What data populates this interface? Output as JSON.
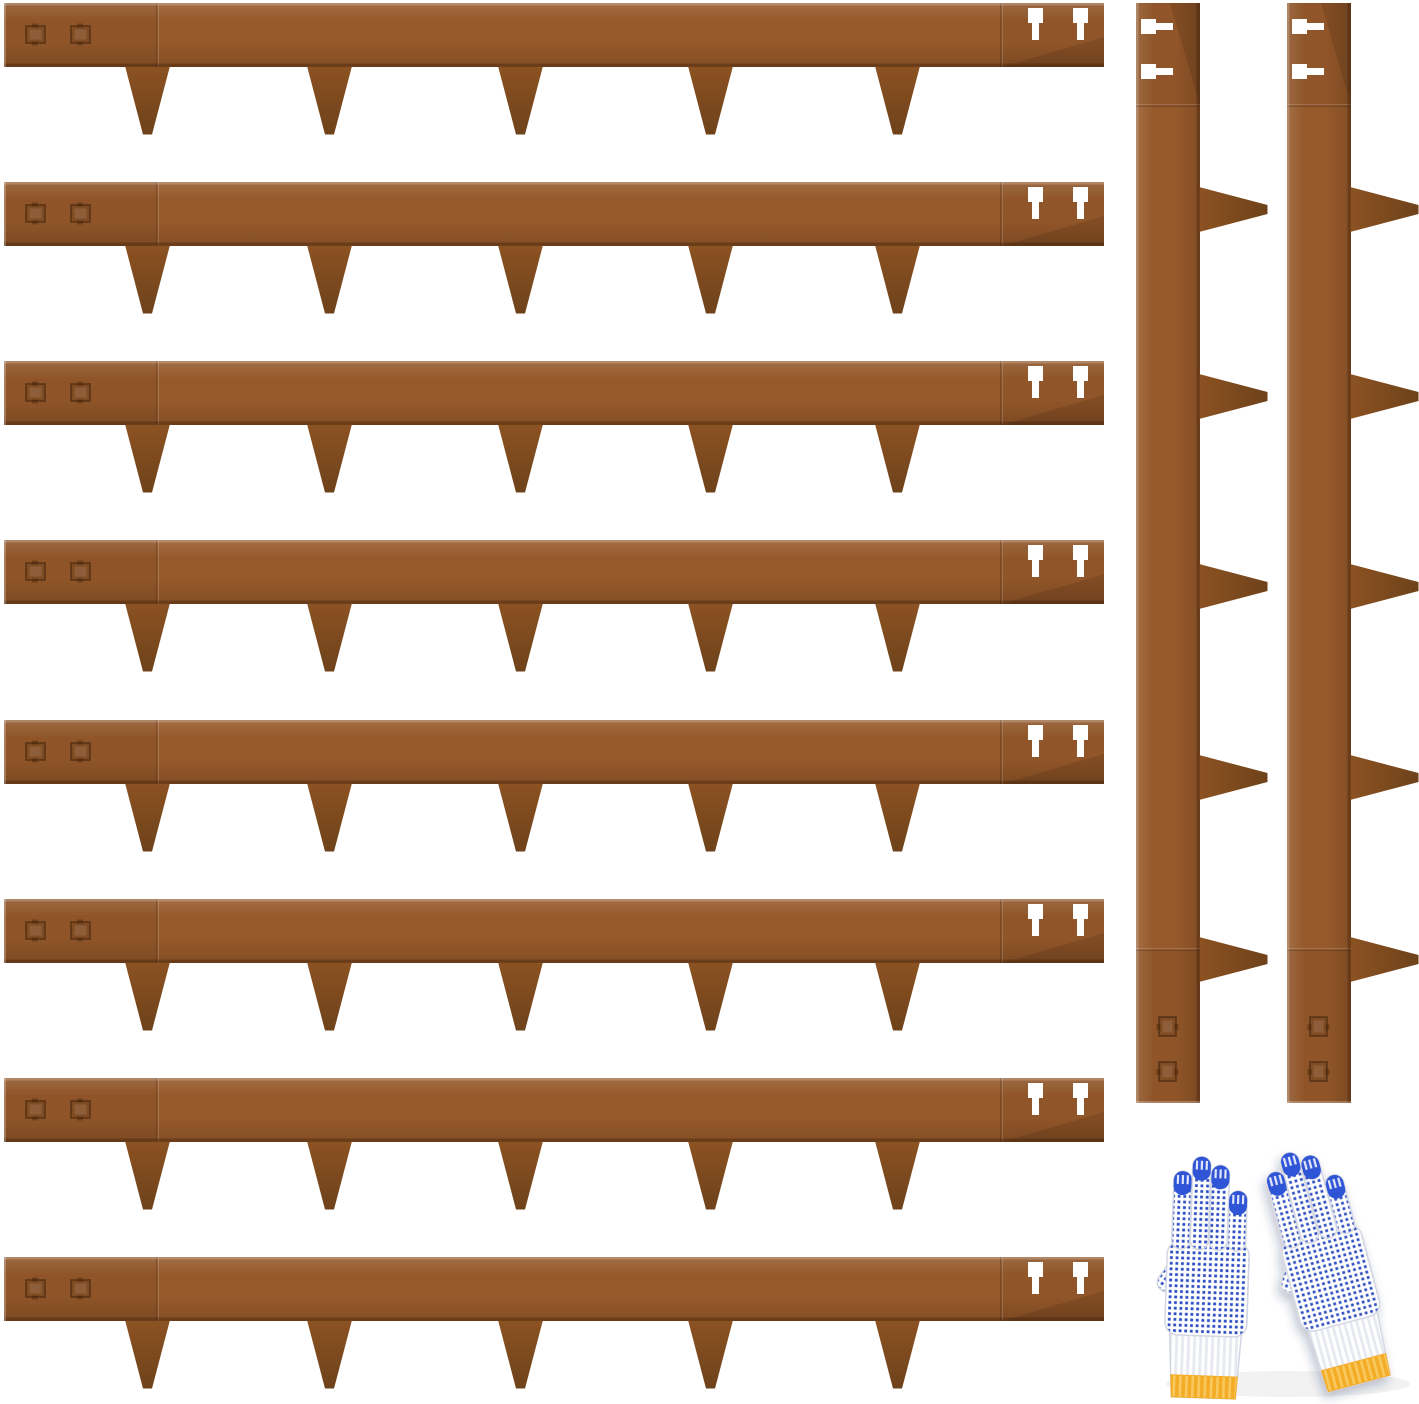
{
  "page": {
    "background": "#ffffff"
  },
  "product_image": {
    "subject": "corten-steel-landscape-edging-kit",
    "edging_strips": {
      "horizontal_count": 8,
      "vertical_count": 2,
      "spikes_per_strip": 5,
      "anchor_slots_per_strip": 2,
      "embossed_marks_per_strip": 2,
      "colors": {
        "base": "#96592a",
        "spike": "#8c5222",
        "dark": "#6e421a",
        "seam": "rgba(58,28,5,0.30)"
      }
    },
    "gloves": {
      "pairs": 1,
      "colors": {
        "shell": "#ffffff",
        "dot": "#2d4ec2",
        "fingertip": "#2f55d6",
        "cuff_band": "#f3ac25",
        "cuff_band_light": "#f9c95f",
        "rib": "#e6e9f0",
        "outline": "#d3d7e2"
      }
    }
  }
}
